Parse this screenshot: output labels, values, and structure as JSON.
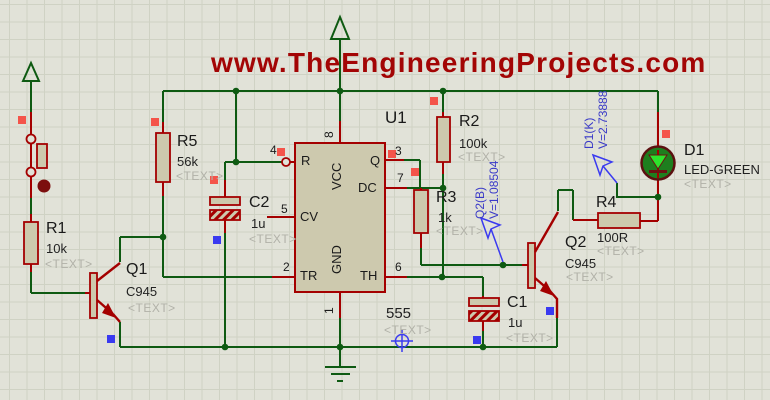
{
  "title": "www.TheEngineeringProjects.com",
  "colors": {
    "background": "#e1e2d8",
    "wire_green": "#0e5a12",
    "component_red": "#a40000",
    "body_fill": "#cdc9ad",
    "title_red": "#a30505",
    "probe_blue": "#3a3af0",
    "marker_red": "#f4544a",
    "marker_blue": "#3a3af0",
    "led_fill": "#1e7e1e",
    "led_triangle": "#2ce42c"
  },
  "components": {
    "r1": {
      "ref": "R1",
      "value": "10k",
      "text": "<TEXT>"
    },
    "r2": {
      "ref": "R2",
      "value": "100k",
      "text": "<TEXT>"
    },
    "r3": {
      "ref": "R3",
      "value": "1k",
      "text": "<TEXT>"
    },
    "r4": {
      "ref": "R4",
      "value": "100R",
      "text": "<TEXT>"
    },
    "r5": {
      "ref": "R5",
      "value": "56k",
      "text": "<TEXT>"
    },
    "c1": {
      "ref": "C1",
      "value": "1u",
      "text": "<TEXT>"
    },
    "c2": {
      "ref": "C2",
      "value": "1u",
      "text": "<TEXT>"
    },
    "q1": {
      "ref": "Q1",
      "value": "C945",
      "text": "<TEXT>"
    },
    "q2": {
      "ref": "Q2",
      "value": "C945",
      "text": "<TEXT>"
    },
    "d1": {
      "ref": "D1",
      "value": "LED-GREEN",
      "text": "<TEXT>"
    },
    "u1": {
      "ref": "U1",
      "value": "555",
      "text": "<TEXT>"
    }
  },
  "ic": {
    "pins": {
      "r": "R",
      "cv": "CV",
      "tr": "TR",
      "q": "Q",
      "dc": "DC",
      "th": "TH",
      "vcc": "VCC",
      "gnd": "GND"
    },
    "numbers": {
      "p8": "8",
      "p4": "4",
      "p5": "5",
      "p2": "2",
      "p3": "3",
      "p7": "7",
      "p6": "6",
      "p1": "1"
    }
  },
  "probes": {
    "q2b": {
      "name": "Q2(B)",
      "reading": "V=1.08504"
    },
    "d1k": {
      "name": "D1(K)",
      "reading": "V=2.73888"
    }
  }
}
